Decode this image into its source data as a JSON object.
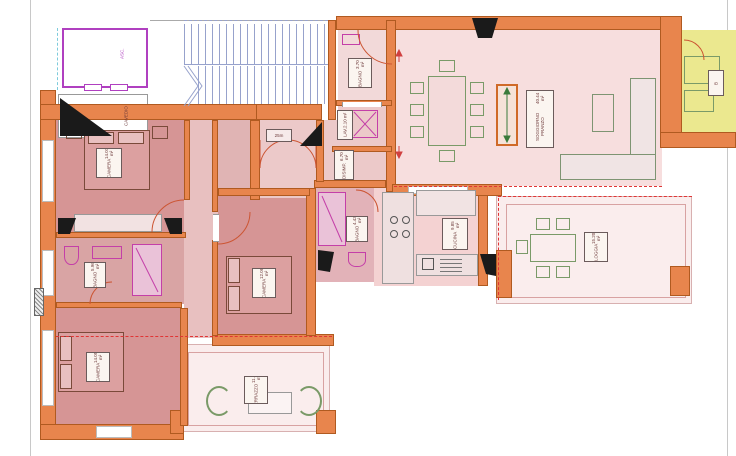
{
  "title": "apartment-floor-plan",
  "palette": {
    "wall_orange": "#e8854d",
    "wall_border": "#b05a20",
    "bedroom_fill": "#d69595",
    "corridor_fill": "#e8c0c0",
    "living_fill": "#f7dede",
    "terrace_fill": "#faeded",
    "bath_fill": "#e2b2b8",
    "neighbor_yellow": "#ebe88f",
    "fixture_magenta": "#c43fa8",
    "furniture_green": "#7a9a68",
    "bed_brown": "#7a4a3a",
    "stair_blue": "#97a2cc",
    "lift_purple": "#b040c0",
    "dashed_red": "#e03535"
  },
  "labels": {
    "lift": "ASC.",
    "cavedio": "CAVEDIO",
    "entry_dim": "25m",
    "camera1_name": "CAMERA",
    "camera1_area": "14.01 m²",
    "camera2_name": "CAMERA",
    "camera2_area": "14.05 m²",
    "camera3_name": "CAMERA",
    "camera3_area": "12.08 m²",
    "bagno1_name": "BAGNO",
    "bagno1_area": "5.96 m²",
    "bagno2_name": "BAGNO",
    "bagno2_area": "4.43 m²",
    "wc_name": "BAGNO",
    "wc_area": "3.70 m²",
    "lavanderia_name": "LAV.",
    "lavanderia_area": "2.10 m²",
    "disimpegno_name": "DISIMP.",
    "disimpegno_area": "6.70 m²",
    "cucina_name": "CUCINA",
    "cucina_area": "9.85 m²",
    "soggiorno_name": "SOGGIORNO PRANZO",
    "soggiorno_area": "40.44 m²",
    "loggia_name": "LOGGIA",
    "loggia_area": "15.20 m²",
    "terrazzo_name": "TERRAZZO",
    "terrazzo_area": "11.80 m²",
    "neighbor_name": "B"
  }
}
